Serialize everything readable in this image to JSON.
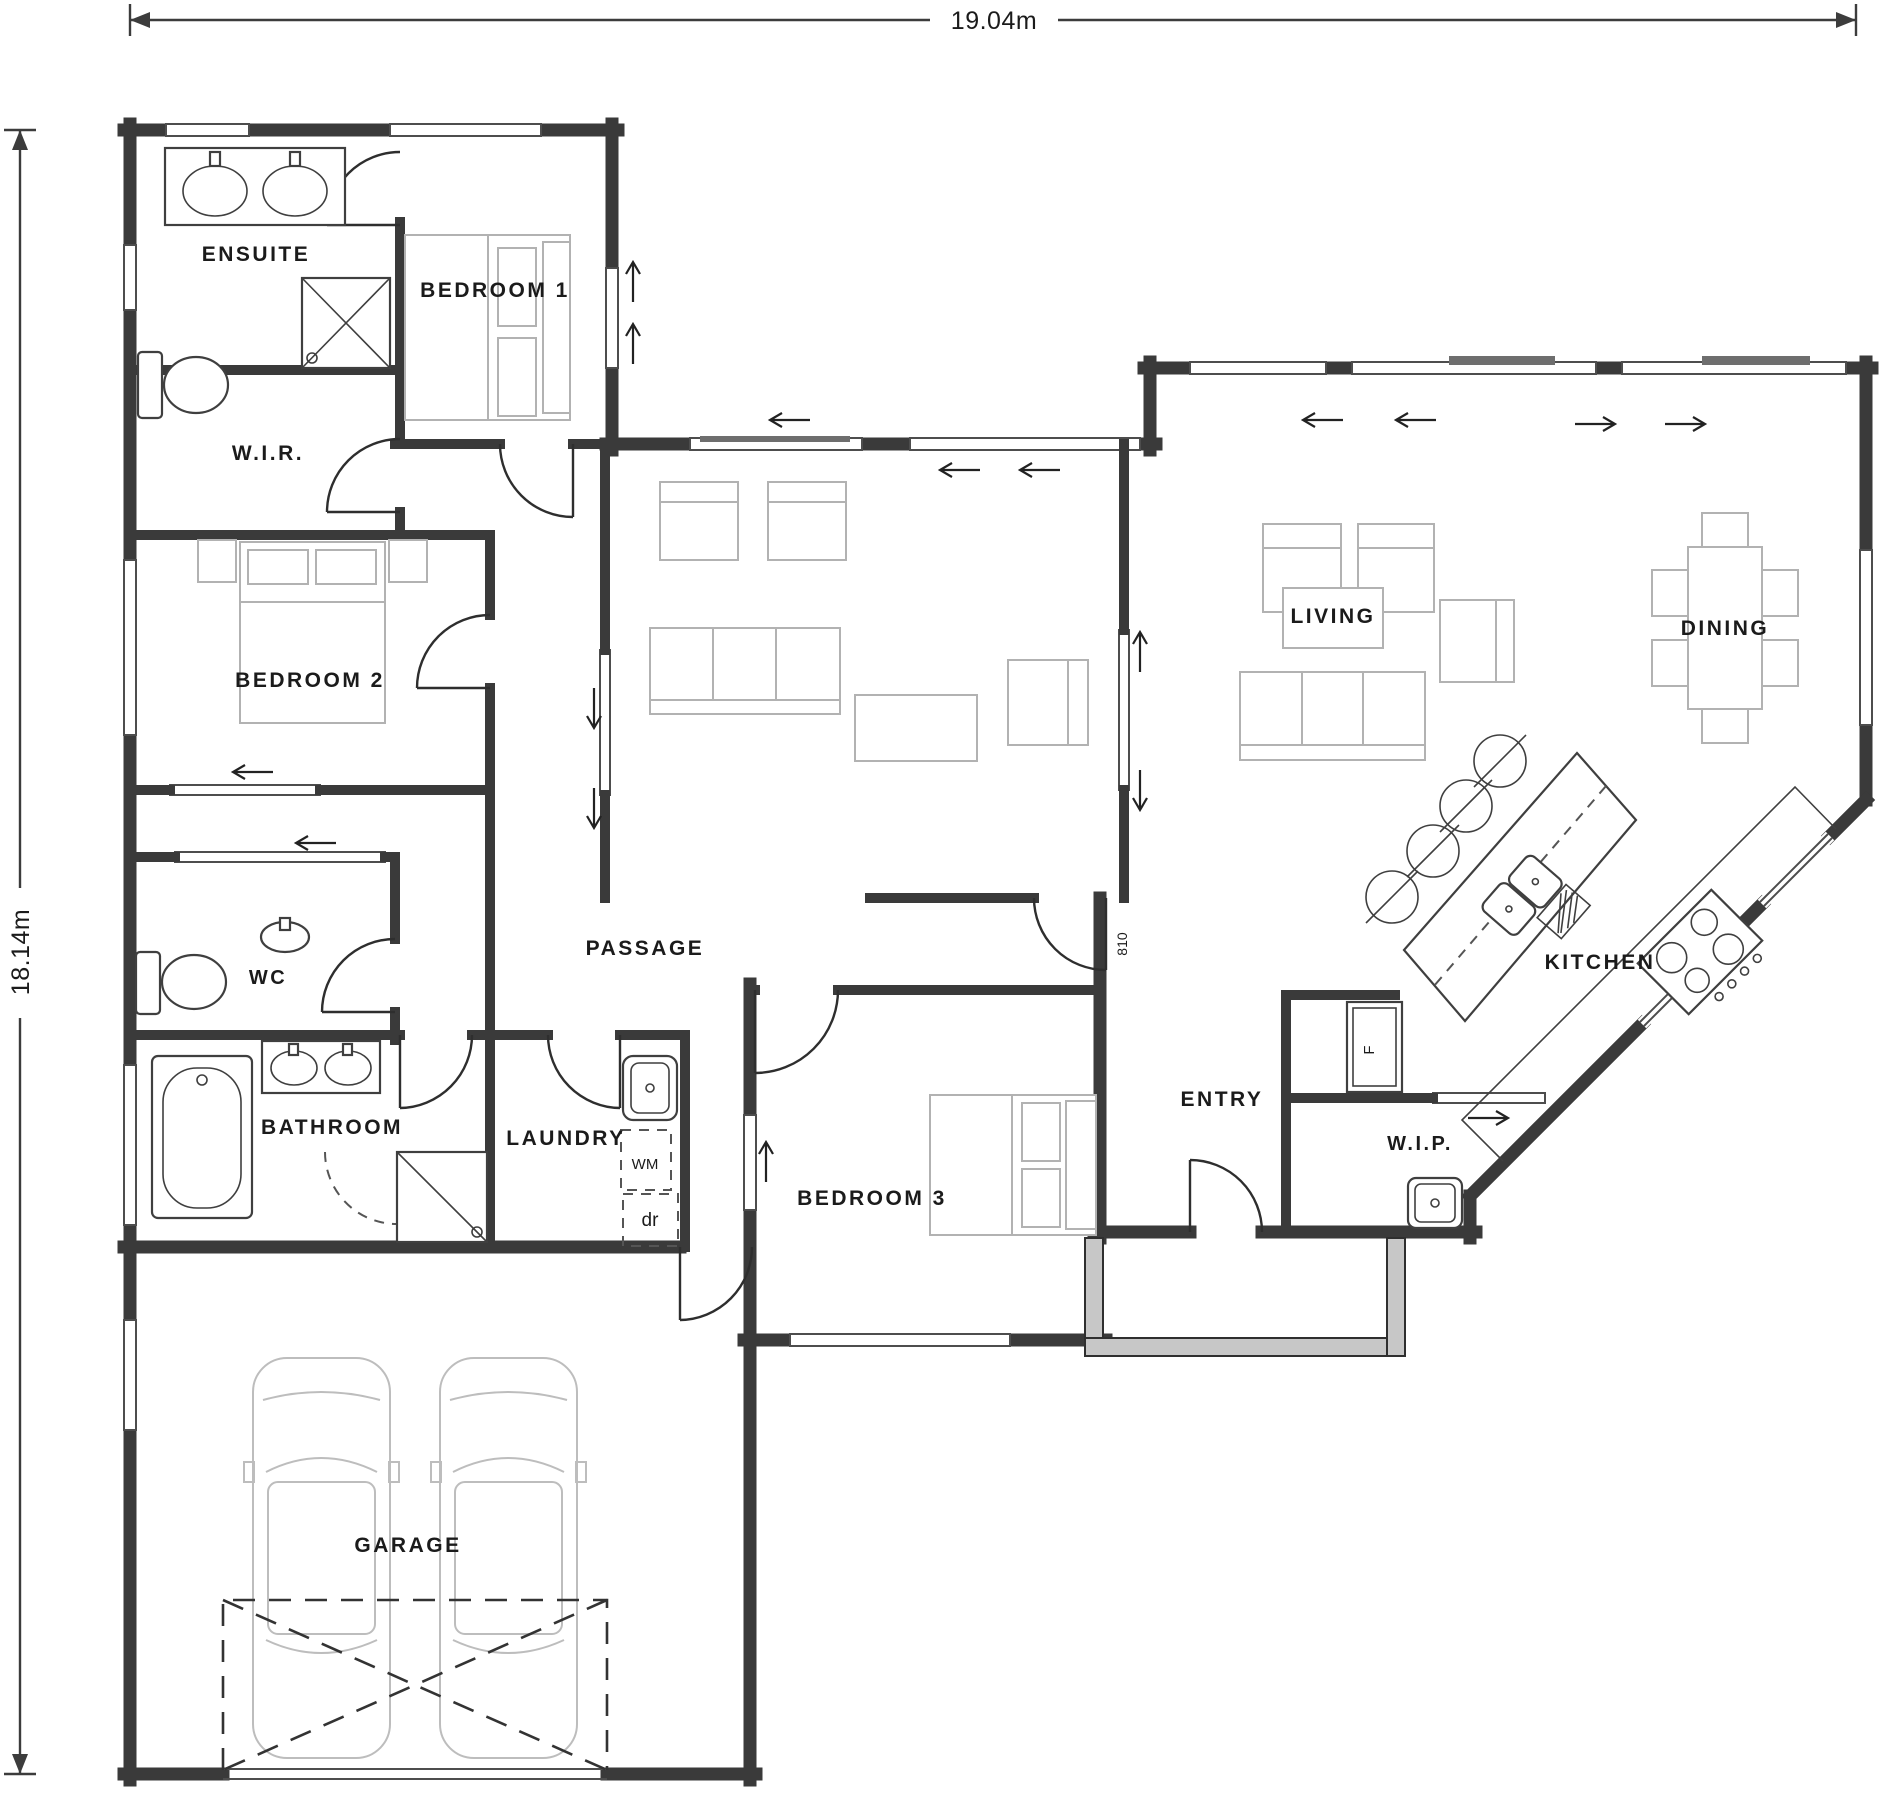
{
  "title": "House floor plan",
  "dimensions": {
    "width_label": "19.04m",
    "height_label": "18.14m"
  },
  "labels": [
    {
      "name": "room-label-ensuite",
      "text": "ENSUITE",
      "x": 256,
      "y": 261,
      "fs": 21
    },
    {
      "name": "room-label-bedroom-1",
      "text": "BEDROOM 1",
      "x": 495,
      "y": 297,
      "fs": 21
    },
    {
      "name": "room-label-wir",
      "text": "W.I.R.",
      "x": 268,
      "y": 460,
      "fs": 21
    },
    {
      "name": "room-label-bedroom-2",
      "text": "BEDROOM 2",
      "x": 310,
      "y": 687,
      "fs": 21
    },
    {
      "name": "room-label-wc",
      "text": "WC",
      "x": 268,
      "y": 984,
      "fs": 20
    },
    {
      "name": "room-label-passage",
      "text": "PASSAGE",
      "x": 645,
      "y": 955,
      "fs": 21
    },
    {
      "name": "room-label-bathroom",
      "text": "BATHROOM",
      "x": 332,
      "y": 1134,
      "fs": 21
    },
    {
      "name": "room-label-laundry",
      "text": "LAUNDRY",
      "x": 566,
      "y": 1145,
      "fs": 21
    },
    {
      "name": "room-label-bedroom-3",
      "text": "BEDROOM 3",
      "x": 872,
      "y": 1205,
      "fs": 21
    },
    {
      "name": "room-label-entry",
      "text": "ENTRY",
      "x": 1222,
      "y": 1106,
      "fs": 21
    },
    {
      "name": "room-label-living",
      "text": "LIVING",
      "x": 1333,
      "y": 623,
      "fs": 21
    },
    {
      "name": "room-label-dining",
      "text": "DINING",
      "x": 1725,
      "y": 635,
      "fs": 21
    },
    {
      "name": "room-label-kitchen",
      "text": "KITCHEN",
      "x": 1600,
      "y": 969,
      "fs": 21
    },
    {
      "name": "room-label-wip",
      "text": "W.I.P.",
      "x": 1420,
      "y": 1150,
      "fs": 20
    },
    {
      "name": "room-label-garage",
      "text": "GARAGE",
      "x": 408,
      "y": 1552,
      "fs": 21
    },
    {
      "name": "appliance-label-washing-machine",
      "text": "WM",
      "x": 645,
      "y": 1169,
      "fs": 15,
      "ls": 0,
      "bold": false
    },
    {
      "name": "appliance-label-dryer",
      "text": "dr",
      "x": 650,
      "y": 1226,
      "fs": 19,
      "ls": 0,
      "bold": false
    },
    {
      "name": "appliance-label-fridge",
      "text": "F",
      "x": 1374,
      "y": 1050,
      "fs": 15,
      "ls": 0,
      "rot": -90,
      "bold": false
    },
    {
      "name": "door-width-label",
      "text": "810",
      "x": 1127,
      "y": 944,
      "fs": 14,
      "ls": 0,
      "rot": -90,
      "bold": false
    }
  ]
}
